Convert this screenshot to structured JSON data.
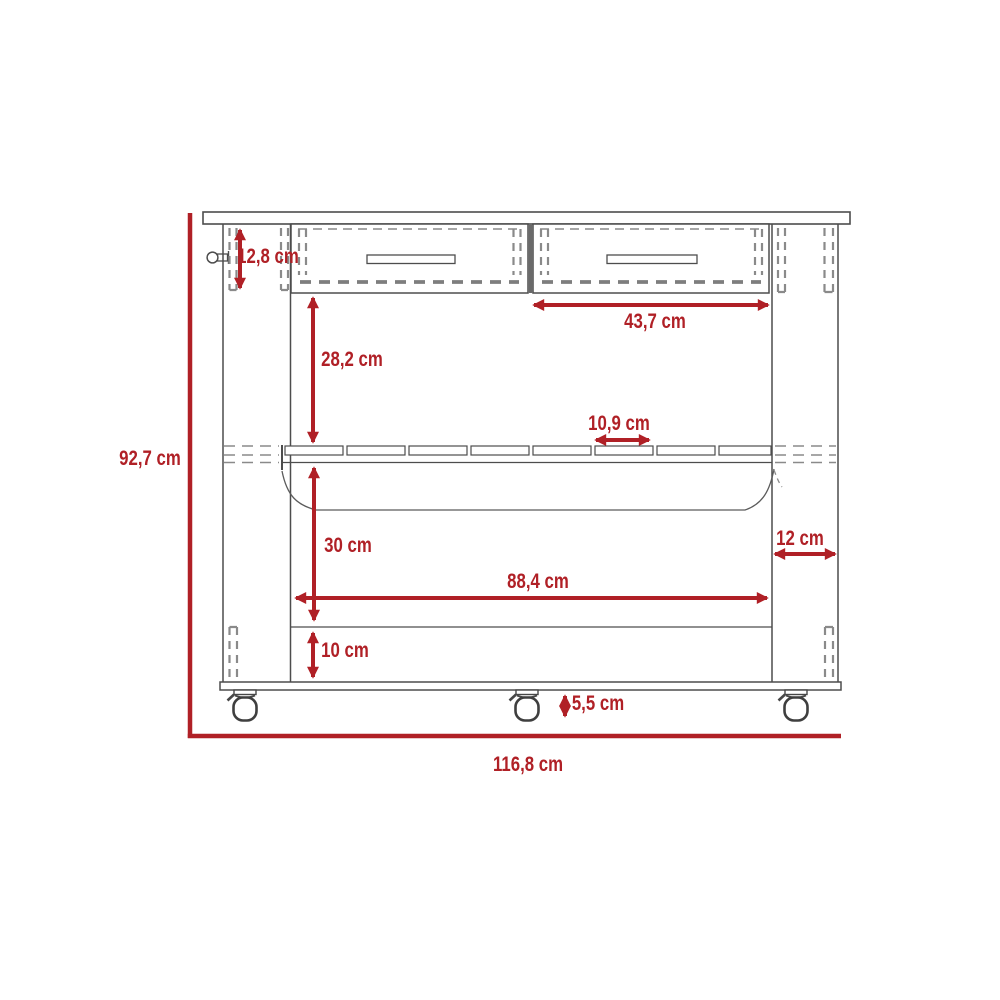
{
  "diagram": {
    "type": "furniture-dimension-drawing",
    "subject": "kitchen island cart front elevation with two drawers, slatted shelf, basket, base shelf and casters",
    "unit": "cm",
    "colors": {
      "dimension": "#b02026",
      "outline": "#4d4d4d",
      "hidden_line": "#8a8a8a",
      "background": "#ffffff"
    },
    "dimensions": {
      "overall_height": "92,7 cm",
      "overall_width": "116,8 cm",
      "drawer_section_height": "12,8 cm",
      "drawer_width": "43,7 cm",
      "drawer_to_shelf": "28,2 cm",
      "slat_width": "10,9 cm",
      "shelf_to_base": "30 cm",
      "side_panel_depth": "12 cm",
      "interior_width": "88,4 cm",
      "base_section_height": "10 cm",
      "caster_height": "5,5 cm"
    }
  }
}
